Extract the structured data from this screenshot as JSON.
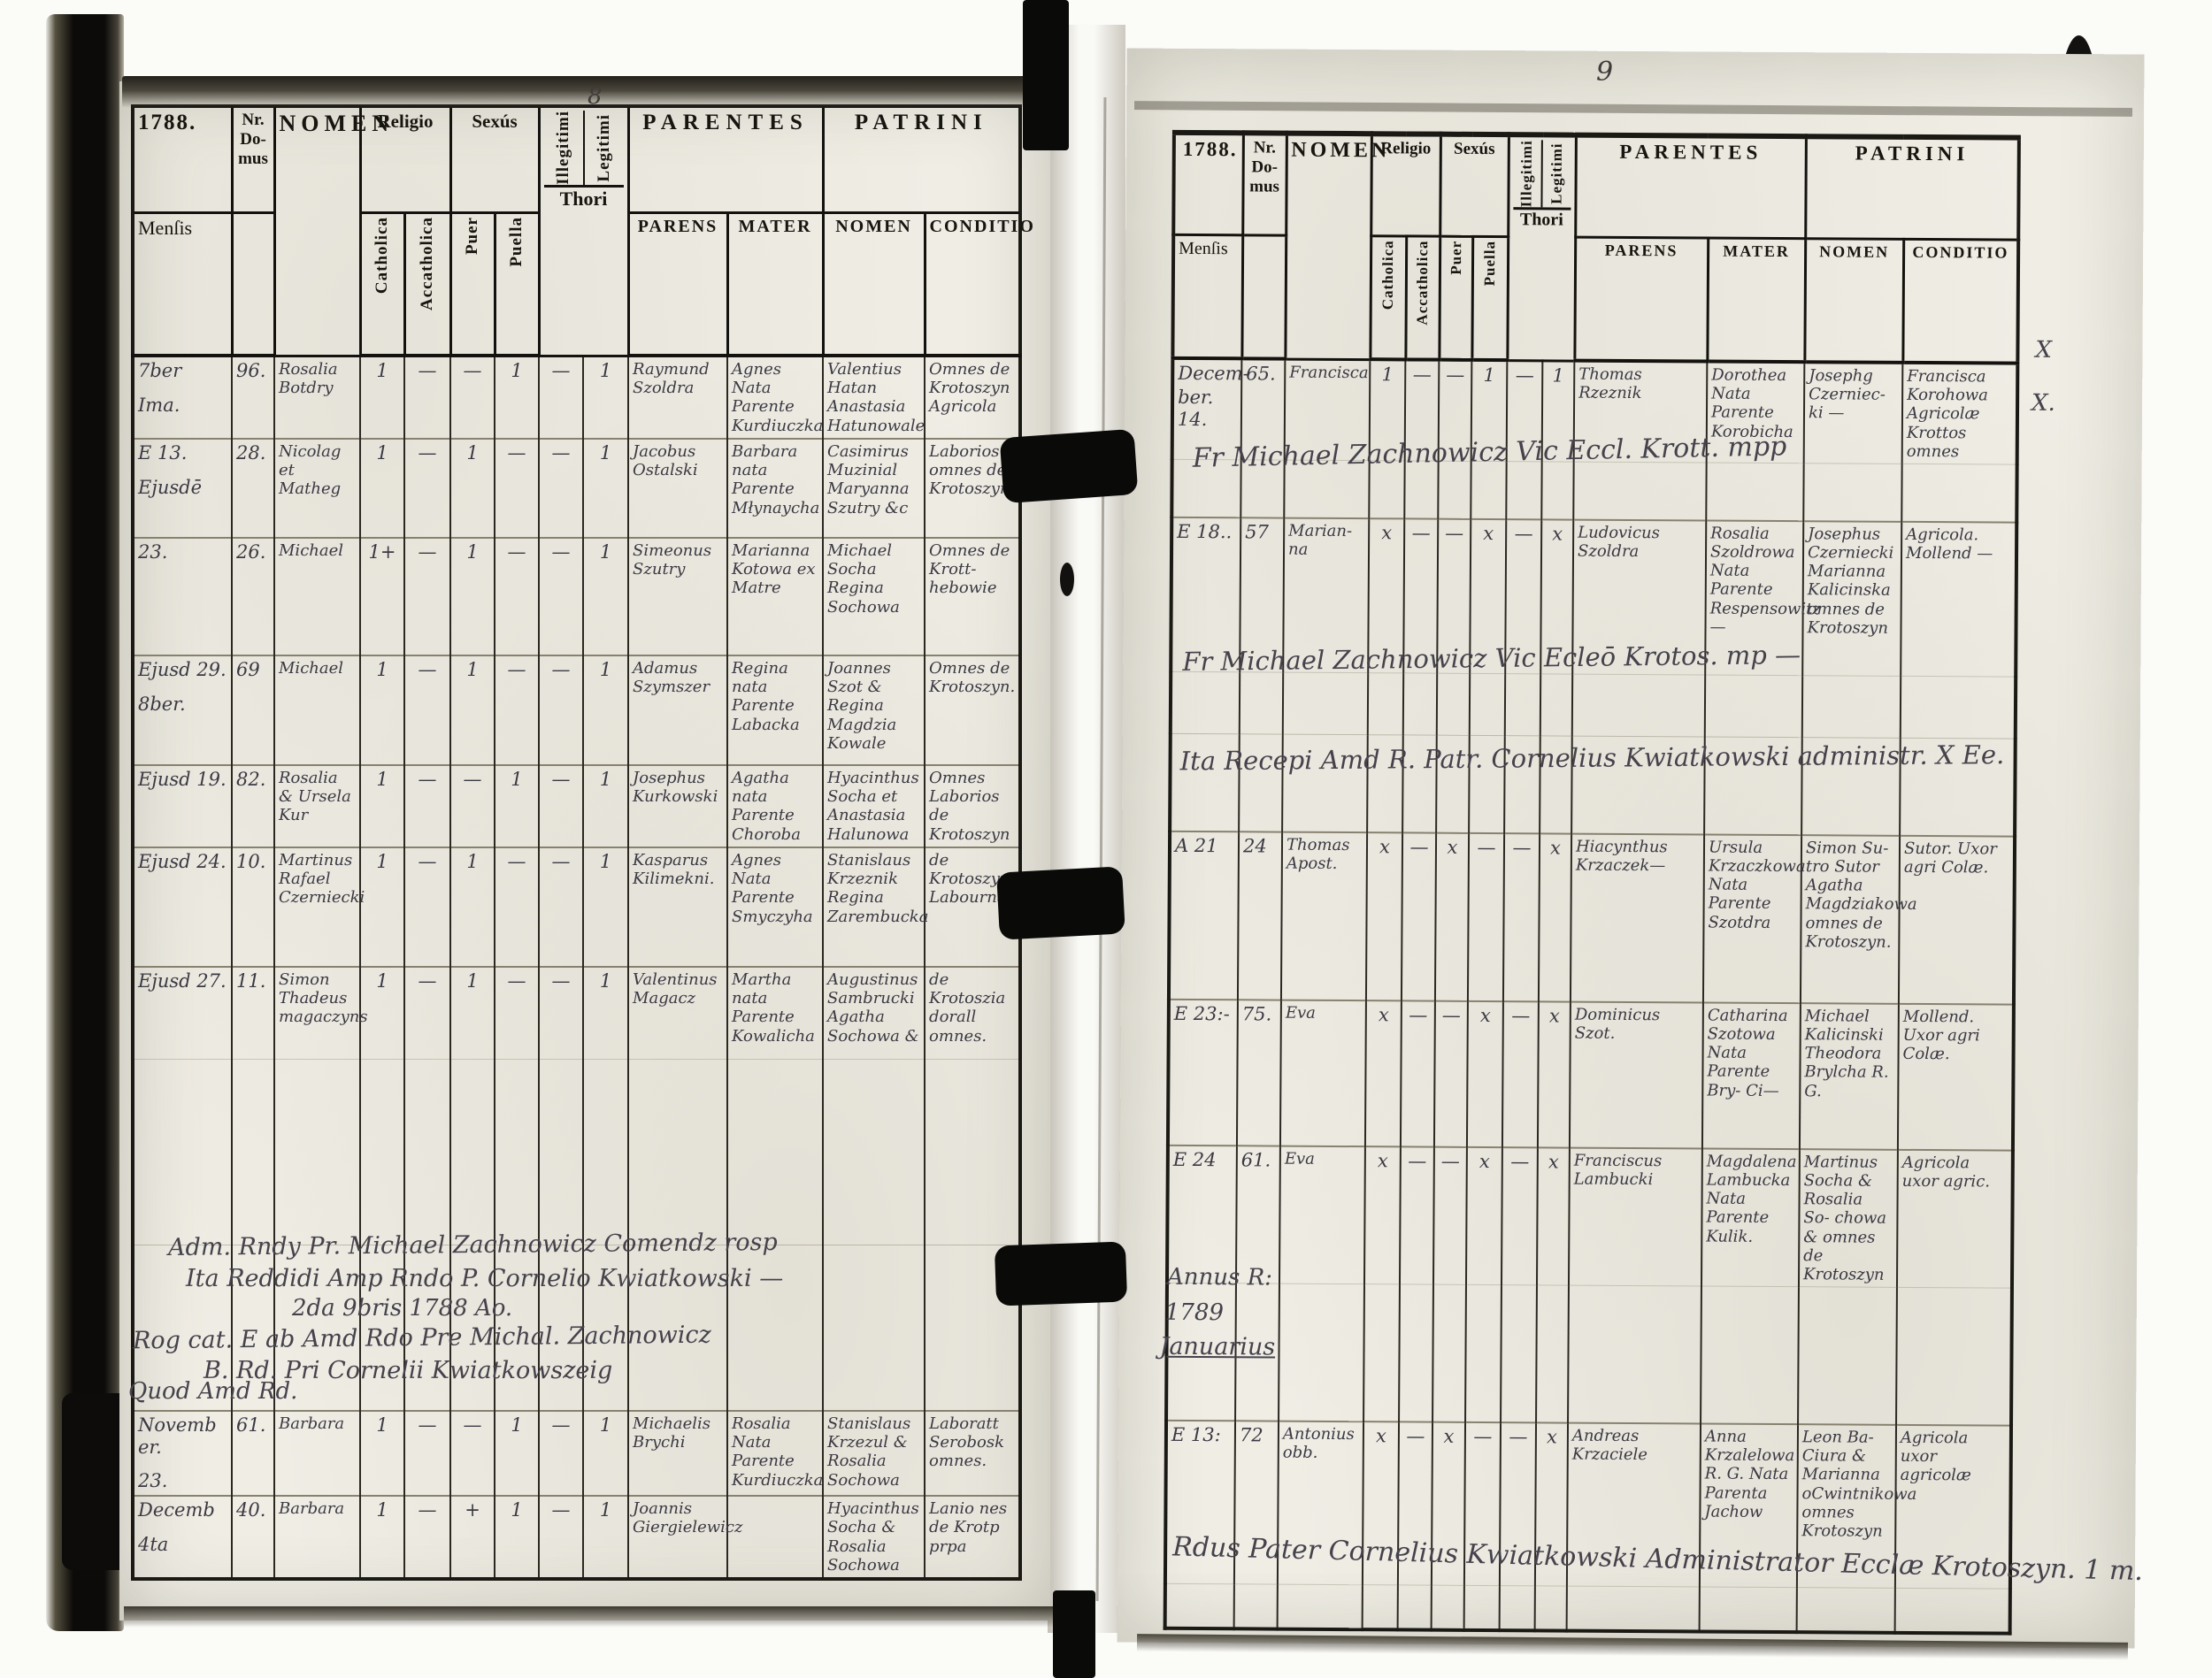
{
  "scan": {
    "left_page_number": "8",
    "right_page_number": "9"
  },
  "header": {
    "year": "1788.",
    "nr_domus": "Nr. Do- mus",
    "nomen": "NOMEN",
    "religio": "Religio",
    "sexus": "Sexús",
    "catholica": "Catholica",
    "accatholica": "Accatholica",
    "puer": "Puer",
    "puella": "Puella",
    "illegitimi": "Illegitimi",
    "legitimi": "Legitimi",
    "thori": "Thori",
    "mensis": "Menſis",
    "parentes": "PARENTES",
    "patrini": "PATRINI",
    "parens": "PARENS",
    "mater": "MATER",
    "p_nomen": "NOMEN",
    "conditio": "CONDITIO"
  },
  "left": {
    "rows": [
      {
        "mensis": "7ber",
        "mensis2": "Ima.",
        "nr": "96.",
        "nomen": "Rosalia Botdry",
        "m": [
          "1",
          "—",
          "—",
          "1",
          "—",
          "1"
        ],
        "parens": "Raymund Szoldra",
        "mater": "Agnes Nata Parente Kurdiuczka",
        "pnomen": "Valentius Hatan Anastasia Hatunowale",
        "cond": "Omnes de Krotoszyn Agricola"
      },
      {
        "mensis": "E 13.",
        "mensis2": "Ejusdē",
        "nr": "28.",
        "nomen": "Nicolag et Matheg",
        "m": [
          "1",
          "—",
          "1",
          "—",
          "—",
          "1"
        ],
        "parens": "Jacobus Ostalski",
        "mater": "Barbara nata Parente Młynaycha",
        "pnomen": "Casimirus Muzinial Maryanna Szutry &c",
        "cond": "Laborios omnes de Krotoszyn"
      },
      {
        "mensis": "23.",
        "mensis2": "",
        "nr": "26.",
        "nomen": "Michael",
        "m": [
          "1+",
          "—",
          "1",
          "—",
          "—",
          "1"
        ],
        "parens": "Simeonus Szutry",
        "mater": "Marianna Kotowa ex Matre",
        "pnomen": "Michael Socha Regina Sochowa",
        "cond": "Omnes de Krott- hebowie"
      },
      {
        "mensis": "Ejusd 29.",
        "mensis2": "8ber.",
        "nr": "69",
        "nomen": "Michael",
        "m": [
          "1",
          "—",
          "1",
          "—",
          "—",
          "1"
        ],
        "parens": "Adamus Szymszer",
        "mater": "Regina nata Parente Labacka",
        "pnomen": "Joannes Szot & Regina Magdzia Kowale",
        "cond": "Omnes de Krotoszyn."
      },
      {
        "mensis": "Ejusd 19.",
        "mensis2": "",
        "nr": "82.",
        "nomen": "Rosalia & Ursela Kur",
        "m": [
          "1",
          "—",
          "—",
          "1",
          "—",
          "1"
        ],
        "parens": "Josephus Kurkowski",
        "mater": "Agatha nata Parente Choroba",
        "pnomen": "Hyacinthus Socha et Anastasia Halunowa",
        "cond": "Omnes Laborios de Krotoszyn"
      },
      {
        "mensis": "Ejusd 24.",
        "mensis2": "",
        "nr": "10.",
        "nomen": "Martinus Rafael Czerniecki",
        "m": [
          "1",
          "—",
          "1",
          "—",
          "—",
          "1"
        ],
        "parens": "Kasparus Kilimekni.",
        "mater": "Agnes Nata Parente Smyczyha",
        "pnomen": "Stanislaus Krzeznik Regina Zarembucka",
        "cond": "de Krotoszyn Labourna"
      },
      {
        "mensis": "Ejusd 27.",
        "mensis2": "",
        "nr": "11.",
        "nomen": "Simon Thadeus magaczyns",
        "m": [
          "1",
          "—",
          "1",
          "—",
          "—",
          "1"
        ],
        "parens": "Valentinus Magacz",
        "mater": "Martha nata Parente Kowalicha",
        "pnomen": "Augustinus Sambrucki Agatha Sochowa &",
        "cond": "de Krotoszia dorall omnes."
      },
      {
        "mensis": "Novemb er.",
        "mensis2": "23.",
        "nr": "61.",
        "nomen": "Barbara",
        "m": [
          "1",
          "—",
          "—",
          "1",
          "—",
          "1"
        ],
        "parens": "Michaelis Brychi",
        "mater": "Rosalia Nata Parente Kurdiuczka",
        "pnomen": "Stanislaus Krzezul & Rosalia Sochowa",
        "cond": "Laboratt Serobosk omnes."
      },
      {
        "mensis": "Decemb",
        "mensis2": "4ta",
        "nr": "40.",
        "nomen": "Barbara",
        "m": [
          "1",
          "—",
          "+",
          "1",
          "—",
          "1"
        ],
        "parens": "Joannis Giergielewicz",
        "mater": "",
        "pnomen": "Hyacinthus Socha & Rosalia Sochowa",
        "cond": "Lanio nes de Krotp prpa"
      }
    ],
    "notes": {
      "l1": "Adm. Rndy Pr. Michael Zachnowicz Comendz rosp",
      "l2": "Ita Reddidi Amp Rndo P. Cornelio Kwiatkowski —",
      "l3": "2da 9bris 1788 Ao.",
      "l4": "Rog cat. E ab Amd Rdo Pre Michal. Zachnowicz",
      "l5": "B. Rd. Pri Cornelii Kwiatkowszeig",
      "l6": "Quod Amd Rd."
    }
  },
  "right": {
    "rows": [
      {
        "mensis": "Decem-",
        "mensis2": "ber. 14.",
        "nr": "65.",
        "nomen": "Francisca",
        "m": [
          "1",
          "—",
          "—",
          "1",
          "—",
          "1"
        ],
        "parens": "Thomas Rzeznik",
        "mater": "Dorothea Nata Parente Korobicha",
        "pnomen": "Josephg Czerniec- ki —",
        "cond": "Francisca Korohowa Agricolæ Krottos omnes"
      },
      {
        "mensis": "E 18..",
        "mensis2": "",
        "nr": "57",
        "nomen": "Marian- na",
        "m": [
          "x",
          "—",
          "—",
          "x",
          "—",
          "x"
        ],
        "parens": "Ludovicus Szoldra",
        "mater": "Rosalia Szoldrowa Nata Parente Respensowitz —",
        "pnomen": "Josephus Czerniecki Marianna Kalicinska omnes de Krotoszyn",
        "cond": "Agricola. Mollend —"
      },
      {
        "mensis": "A 21",
        "mensis2": "",
        "nr": "24",
        "nomen": "Thomas Apost.",
        "m": [
          "x",
          "—",
          "x",
          "—",
          "—",
          "x"
        ],
        "parens": "Hiacynthus Krzaczek—",
        "mater": "Ursula Krzaczkowa Nata Parente Szotdra",
        "pnomen": "Simon Su- tro Sutor Agatha Magdziakowa omnes de Krotoszyn.",
        "cond": "Sutor. Uxor agri Colæ."
      },
      {
        "mensis": "E 23:-",
        "mensis2": "",
        "nr": "75.",
        "nomen": "Eva",
        "m": [
          "x",
          "—",
          "—",
          "x",
          "—",
          "x"
        ],
        "parens": "Dominicus Szot.",
        "mater": "Catharina Szotowa Nata Parente Bry- Ci—",
        "pnomen": "Michael Kalicinski Theodora Brylcha R. G.",
        "cond": "Mollend. Uxor agri Colæ."
      },
      {
        "mensis": "E 24",
        "mensis2": "",
        "nr": "61.",
        "nomen": "Eva",
        "m": [
          "x",
          "—",
          "—",
          "x",
          "—",
          "x"
        ],
        "parens": "Franciscus Lambucki",
        "mater": "Magdalena Lambucka Nata Parente Kulik.",
        "pnomen": "Martinus Socha & Rosalia So- chowa & omnes de Krotoszyn",
        "cond": "Agricola uxor agric."
      },
      {
        "mensis": "E 13:",
        "mensis2": "",
        "nr": "72",
        "nomen": "Antonius obb.",
        "m": [
          "x",
          "—",
          "x",
          "—",
          "—",
          "x"
        ],
        "parens": "Andreas Krzaciele",
        "mater": "Anna Krzalelowa R. G. Nata Parenta Jachow",
        "pnomen": "Leon Ba- Ciura & Marianna oCwintnikowa omnes Krotoszyn",
        "cond": "Agricola uxor agricolæ"
      }
    ],
    "notes": {
      "vicar1": "Fr Michael Zachnowicz Vic Eccl. Krott. mpp",
      "vicar2": "Fr Michael Zachnowicz Vic Ecleō Krotos. mp —",
      "receipt": "Ita Recepi Amd R. Patr. Cornelius Kwiatkowski administr. X Ee.",
      "annus1": "Annus R:",
      "annus2": "1789",
      "annus3": "Januarius",
      "bottom": "Rdus Pater Cornelius Kwiatkowski Administrator Ecclæ Krotoszyn. 1 m.",
      "mark1": "X",
      "mark2": "X."
    }
  }
}
